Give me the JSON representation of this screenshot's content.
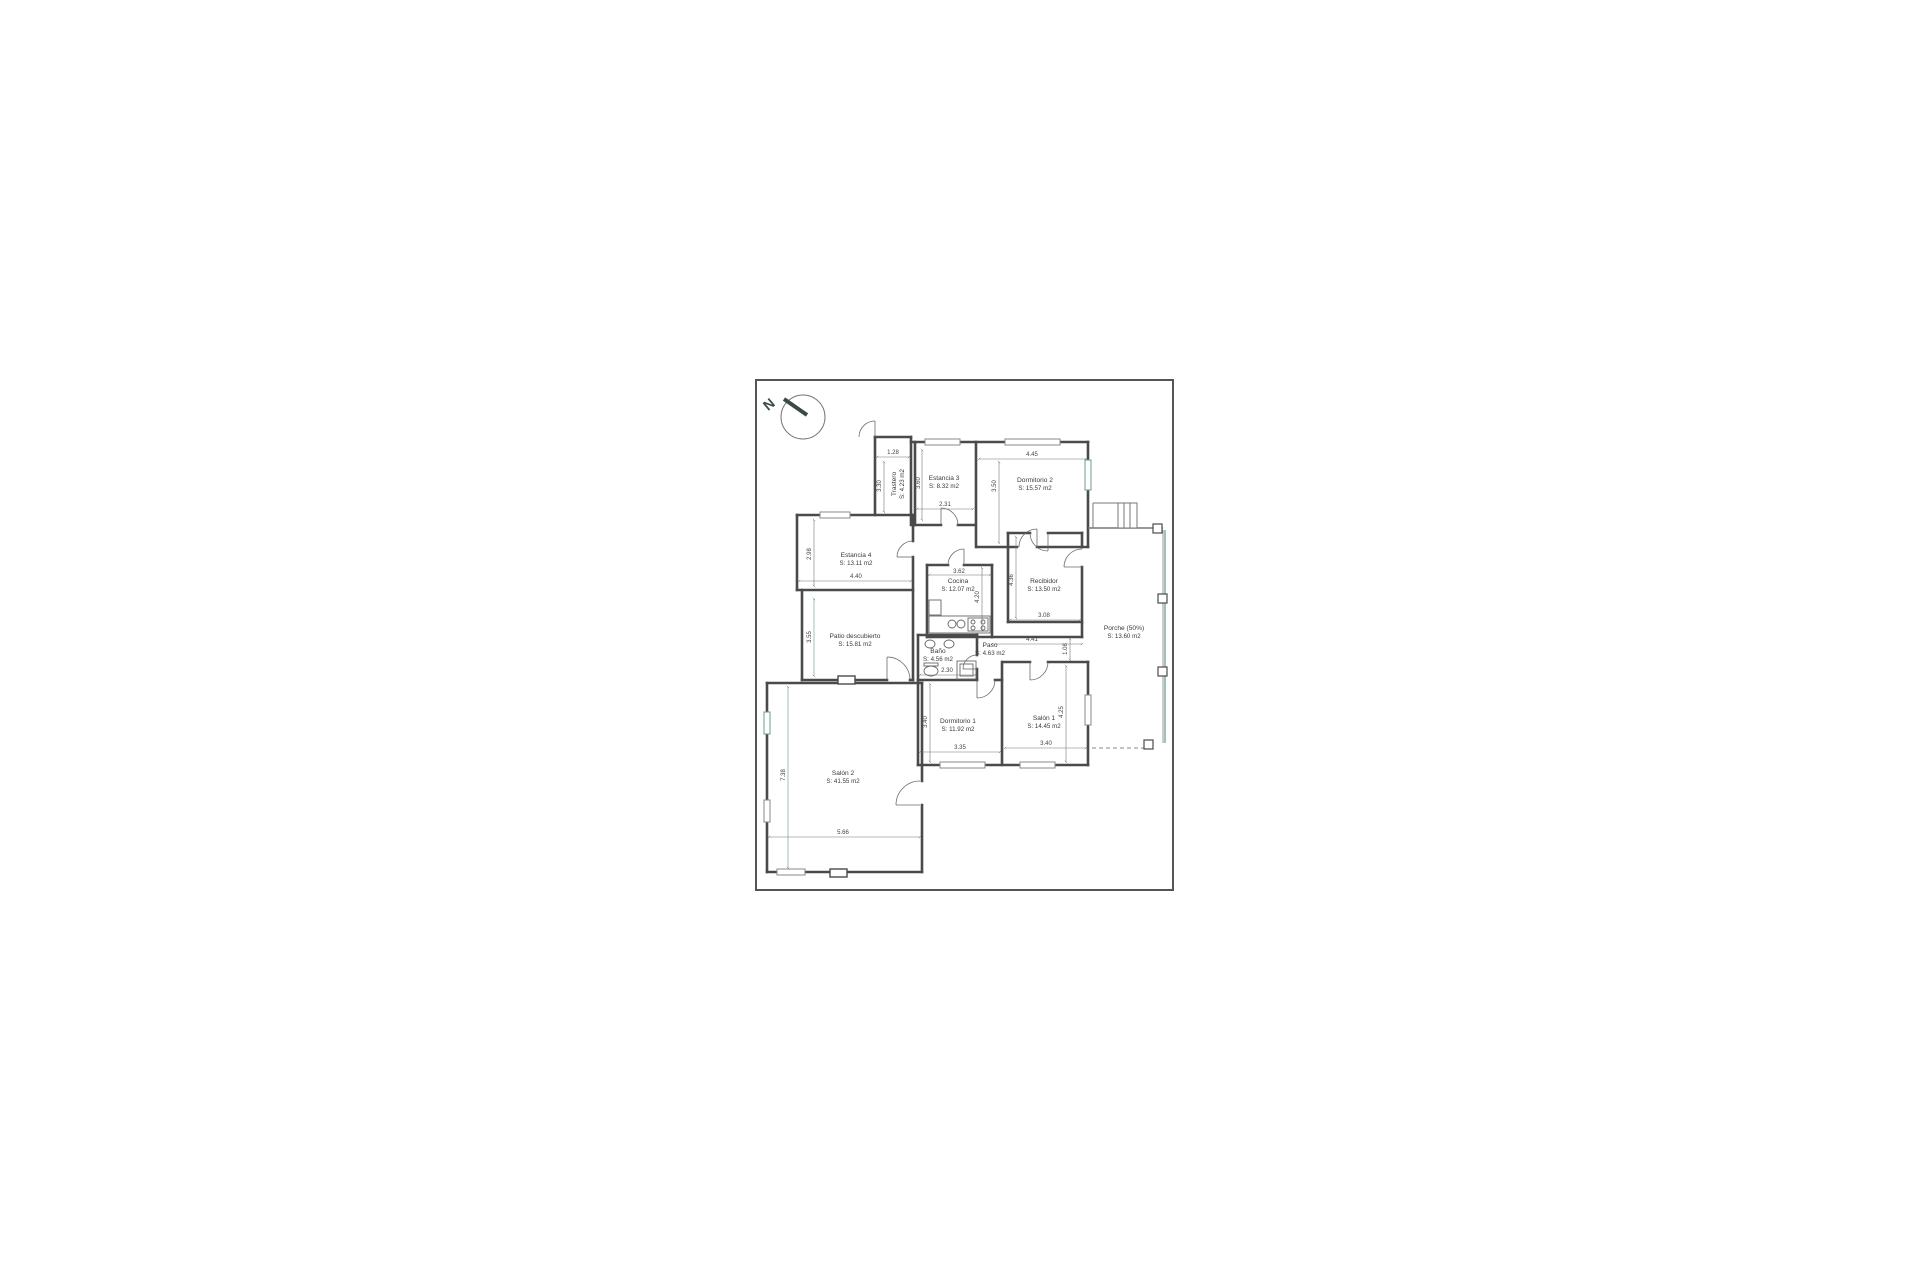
{
  "plan": {
    "north_label": "N",
    "rooms": [
      {
        "name": "Trastero",
        "area": "S: 4.23 m2"
      },
      {
        "name": "Estancia 3",
        "area": "S: 8.32 m2"
      },
      {
        "name": "Dormitorio 2",
        "area": "S: 15.57 m2"
      },
      {
        "name": "Estancia 4",
        "area": "S: 13.11 m2"
      },
      {
        "name": "Cocina",
        "area": "S: 12.07 m2"
      },
      {
        "name": "Recibidor",
        "area": "S: 13.50 m2"
      },
      {
        "name": "Porche (50%)",
        "area": "S: 13.60 m2"
      },
      {
        "name": "Patio descubierto",
        "area": "S: 15.81 m2"
      },
      {
        "name": "Baño",
        "area": "S: 4.56 m2"
      },
      {
        "name": "Paso",
        "area": "S: 4.63 m2"
      },
      {
        "name": "Dormitorio 1",
        "area": "S: 11.92 m2"
      },
      {
        "name": "Salón 1",
        "area": "S: 14.45 m2"
      },
      {
        "name": "Salón 2",
        "area": "S: 41.55 m2"
      }
    ],
    "dimensions": {
      "trastero_w": "1.28",
      "trastero_h": "3.30",
      "estancia3_h": "3.60",
      "estancia3_w": "2.31",
      "dormitorio2_w": "4.45",
      "dormitorio2_h": "3.50",
      "estancia4_h": "2.98",
      "estancia4_w": "4.40",
      "patio_h": "3.55",
      "cocina_w": "3.62",
      "cocina_h": "4.20",
      "recibidor_h": "4.36",
      "recibidor_w": "3.08",
      "paso_w": "4.41",
      "paso_h": "1.08",
      "bano_w": "2.30",
      "dormitorio1_h": "3.40",
      "dormitorio1_w": "3.35",
      "salon1_w": "3.40",
      "salon1_h": "4.25",
      "salon2_h": "7.38",
      "salon2_w": "5.66"
    },
    "colors": {
      "wall": "#4a4a4a",
      "thin": "#888888",
      "accent_teal": "#5f9a8b",
      "border": "#555555"
    }
  }
}
